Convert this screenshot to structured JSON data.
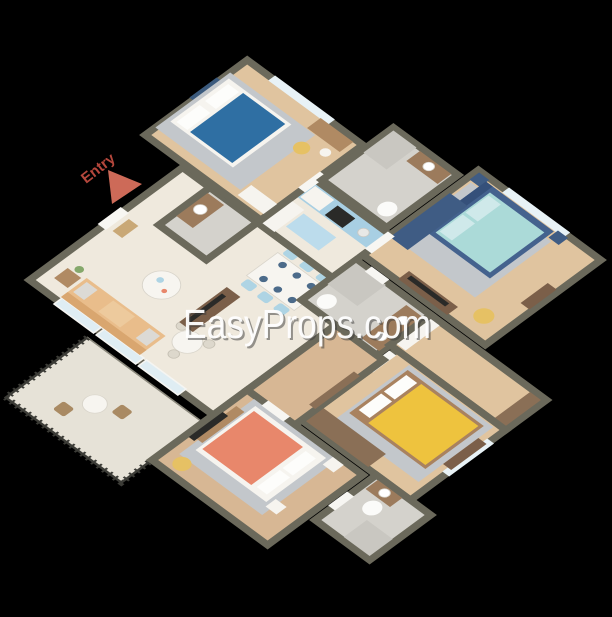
{
  "watermark": {
    "text": "EasyProps.com",
    "color": "#ffffff",
    "shadow_color": "#3a3a3a"
  },
  "entry": {
    "label": "Entry",
    "text_color": "#b5473c",
    "arrow_color": "#cd6a58"
  },
  "palette": {
    "wall": "#6b695b",
    "floor_wood": "#e0c49f",
    "floor_wood_dark": "#d7b794",
    "floor_cream": "#efe9dd",
    "floor_tile": "#d4d2cc",
    "floor_balcony": "#e6e2d7",
    "bed_blue": "#2f6fa3",
    "bed_teal": "#abdad8",
    "bed_navy_frame": "#44628e",
    "bed_yellow": "#eec33e",
    "bed_orange": "#e8876b",
    "sofa_tan": "#e9bd8b",
    "sofa_back_tan": "#d9a66f",
    "dining_chair_blue": "#aed4e4",
    "kitchen_counter_blue": "#a8cfe3",
    "island_blue": "#bcdcec",
    "wardrobe_navy": "#3f5c84",
    "wardrobe_brown": "#8a6f56",
    "armchair_yellow": "#e6c164",
    "rug_gray": "#c3c7cb",
    "railing": "#3c3c37",
    "window_glass": "#e8f2f6",
    "background": "#000000"
  }
}
